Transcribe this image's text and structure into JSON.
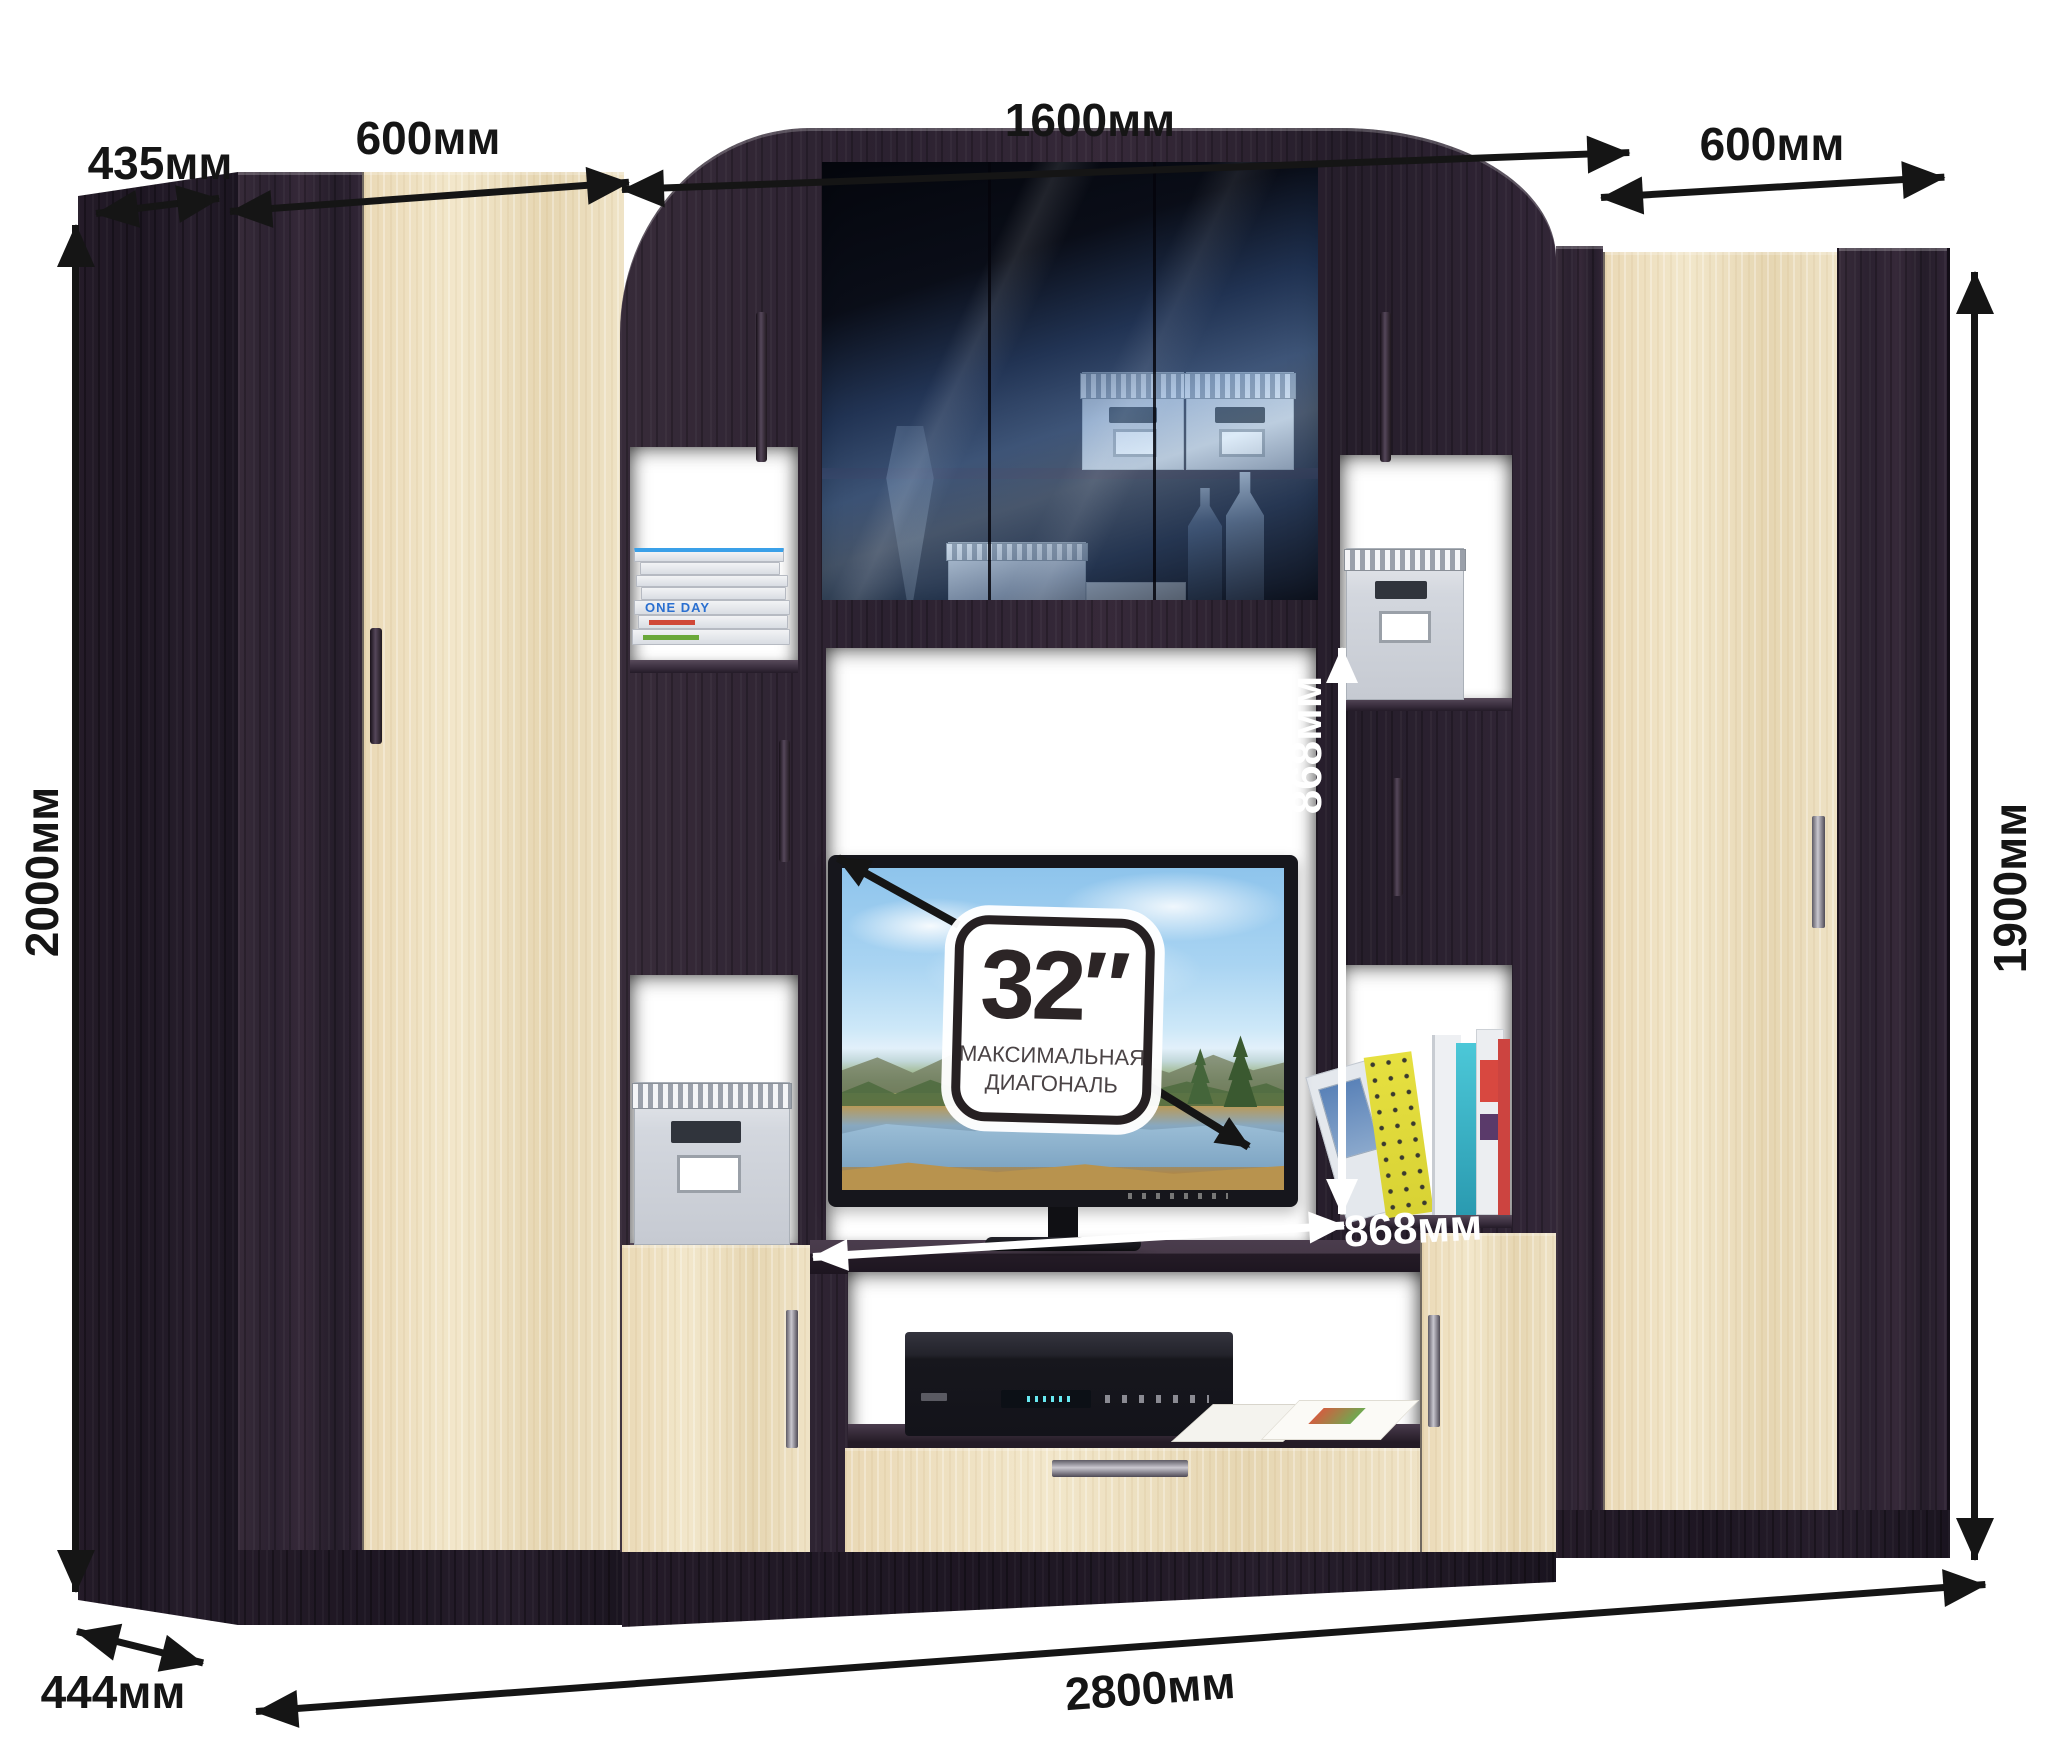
{
  "dimensions": {
    "depth_top": "435мм",
    "left_wardrobe_width": "600мм",
    "center_width": "1600мм",
    "right_wardrobe_width": "600мм",
    "left_height": "2000мм",
    "right_height": "1900мм",
    "niche_height": "868мм",
    "niche_width": "868мм",
    "total_width": "2800мм",
    "depth_bottom": "444мм"
  },
  "tv_badge": {
    "diagonal": "32″",
    "caption_line1": "МАКСИМАЛЬНАЯ",
    "caption_line2": "ДИАГОНАЛЬ"
  },
  "decor": {
    "book_spine_title": "ONE DAY"
  },
  "colors": {
    "wenge": "#2b2130",
    "cream": "#ecdfc1",
    "dimension_black": "#151515",
    "dimension_white": "#ffffff"
  }
}
